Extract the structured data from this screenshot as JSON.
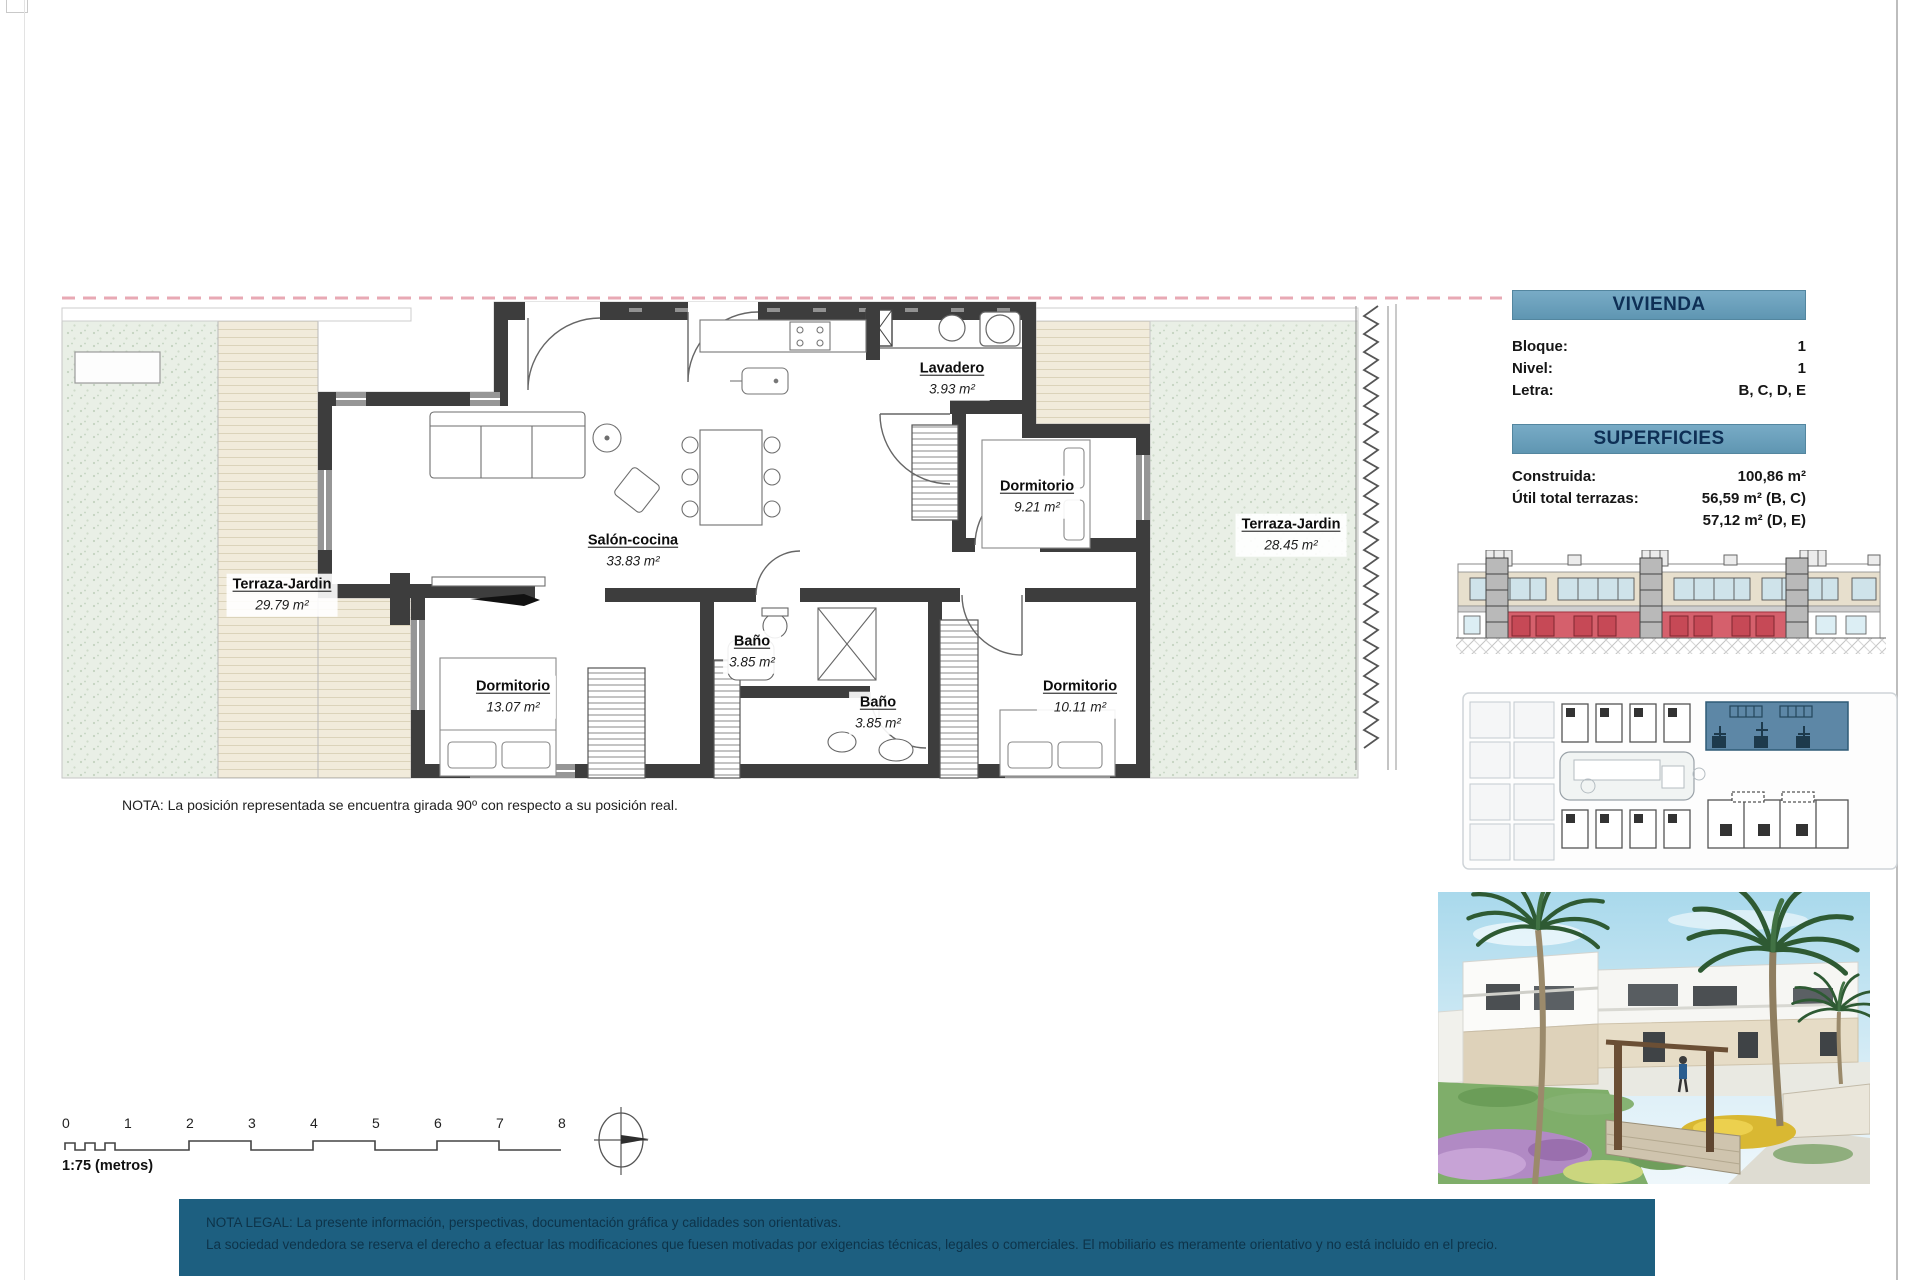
{
  "plan": {
    "note": "NOTA: La posición representada se encuentra girada 90º con respecto a su posición real.",
    "rooms": [
      {
        "name": "Terraza-Jardin",
        "area": "29.79 m²"
      },
      {
        "name": "Salón-cocina",
        "area": "33.83 m²"
      },
      {
        "name": "Lavadero",
        "area": "3.93 m²"
      },
      {
        "name": "Dormitorio",
        "area": "9.21 m²"
      },
      {
        "name": "Terraza-Jardin",
        "area": "28.45 m²"
      },
      {
        "name": "Dormitorio",
        "area": "13.07 m²"
      },
      {
        "name": "Baño",
        "area": "3.85 m²"
      },
      {
        "name": "Baño",
        "area": "3.85 m²"
      },
      {
        "name": "Dormitorio",
        "area": "10.11 m²"
      }
    ],
    "scale": {
      "label": "1:75 (metros)",
      "ticks": [
        "0",
        "1",
        "2",
        "3",
        "4",
        "5",
        "6",
        "7",
        "8"
      ]
    }
  },
  "panel": {
    "vivienda": {
      "title": "VIVIENDA",
      "rows": [
        {
          "label": "Bloque:",
          "value": "1"
        },
        {
          "label": "Nivel:",
          "value": "1"
        },
        {
          "label": "Letra:",
          "value": "B, C, D, E"
        }
      ]
    },
    "superficies": {
      "title": "SUPERFICIES",
      "rows": [
        {
          "label": "Construida:",
          "value": "100,86 m²"
        },
        {
          "label": "Útil total terrazas:",
          "value": "56,59 m² (B, C)"
        },
        {
          "label": "",
          "value": "57,12 m² (D, E)"
        }
      ]
    }
  },
  "legal": {
    "line1": "NOTA LEGAL: La presente información, perspectivas, documentación gráfica y calidades son orientativas.",
    "line2": "La sociedad vendedora se reserva el derecho a efectuar las modificaciones que fuesen motivadas por exigencias técnicas, legales o comerciales. El mobiliario es meramente orientativo y no está incluido en el precio."
  },
  "colors": {
    "header_bg": "#6aa0bd",
    "legal_bg": "#1d5f80",
    "boundary_pink": "#e8a9b4",
    "wall": "#3d3d3d",
    "elevation_highlight": "#d5606c",
    "siteplan_highlight": "#5d87a6"
  }
}
